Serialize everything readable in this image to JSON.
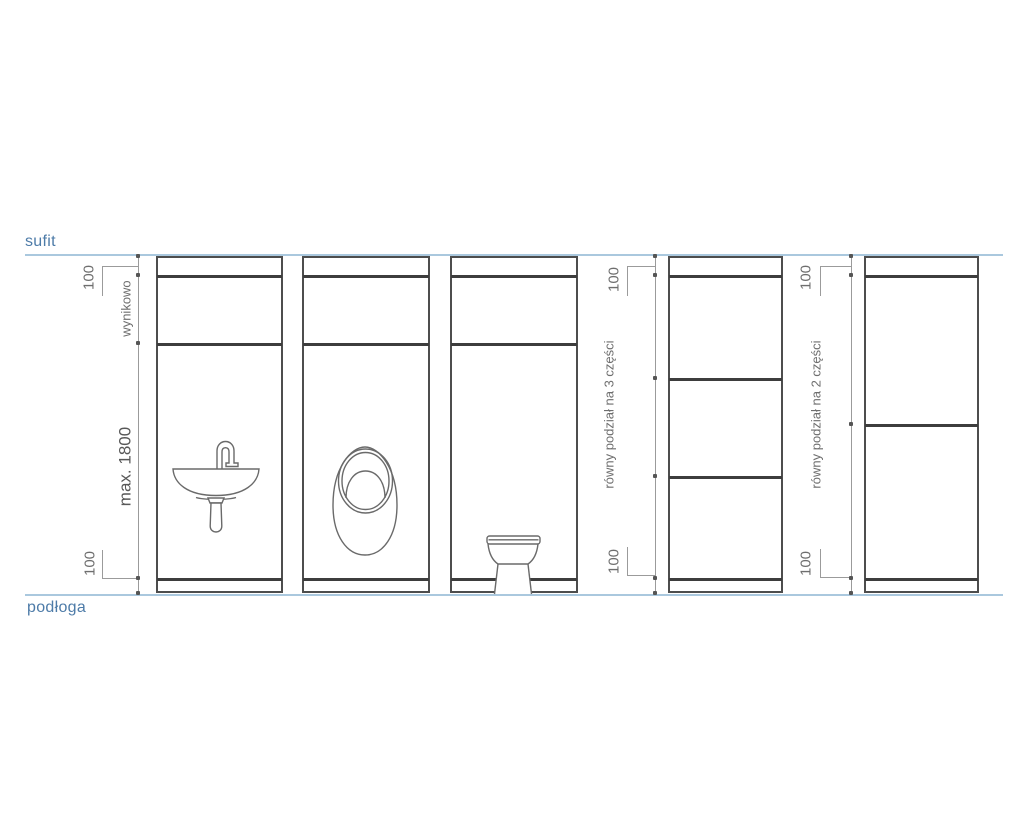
{
  "diagram": {
    "type": "sanitary-wall-elevation",
    "ceiling_label": "sufit",
    "floor_label": "podłoga",
    "dimensions": {
      "top_offset": "100",
      "resulting": "wynikowo",
      "max_height": "max. 1800",
      "bottom_offset": "100",
      "division_3": "równy podział na 3 części",
      "division_2": "równy podział na 2 części"
    },
    "panels": [
      {
        "fixture": "sink",
        "annotations": [
          "100",
          "wynikowo",
          "max. 1800",
          "100"
        ]
      },
      {
        "fixture": "urinal",
        "annotations": [
          "100",
          "wynikowo",
          "max. 1800",
          "100"
        ]
      },
      {
        "fixture": "toilet",
        "annotations": [
          "100",
          "wynikowo",
          "max. 1800",
          "100"
        ]
      },
      {
        "fixture": "none",
        "division": "równy podział na 3 części",
        "annotations": [
          "100",
          "100"
        ]
      },
      {
        "fixture": "none",
        "division": "równy podział na 2 części",
        "annotations": [
          "100",
          "100"
        ]
      }
    ],
    "colors": {
      "guide_line": "#aac8de",
      "guide_text": "#4d7ba8",
      "panel_line": "#3d3d3d",
      "dimension_line": "#9b9b9b",
      "dimension_text": "#6e6e6e"
    }
  }
}
